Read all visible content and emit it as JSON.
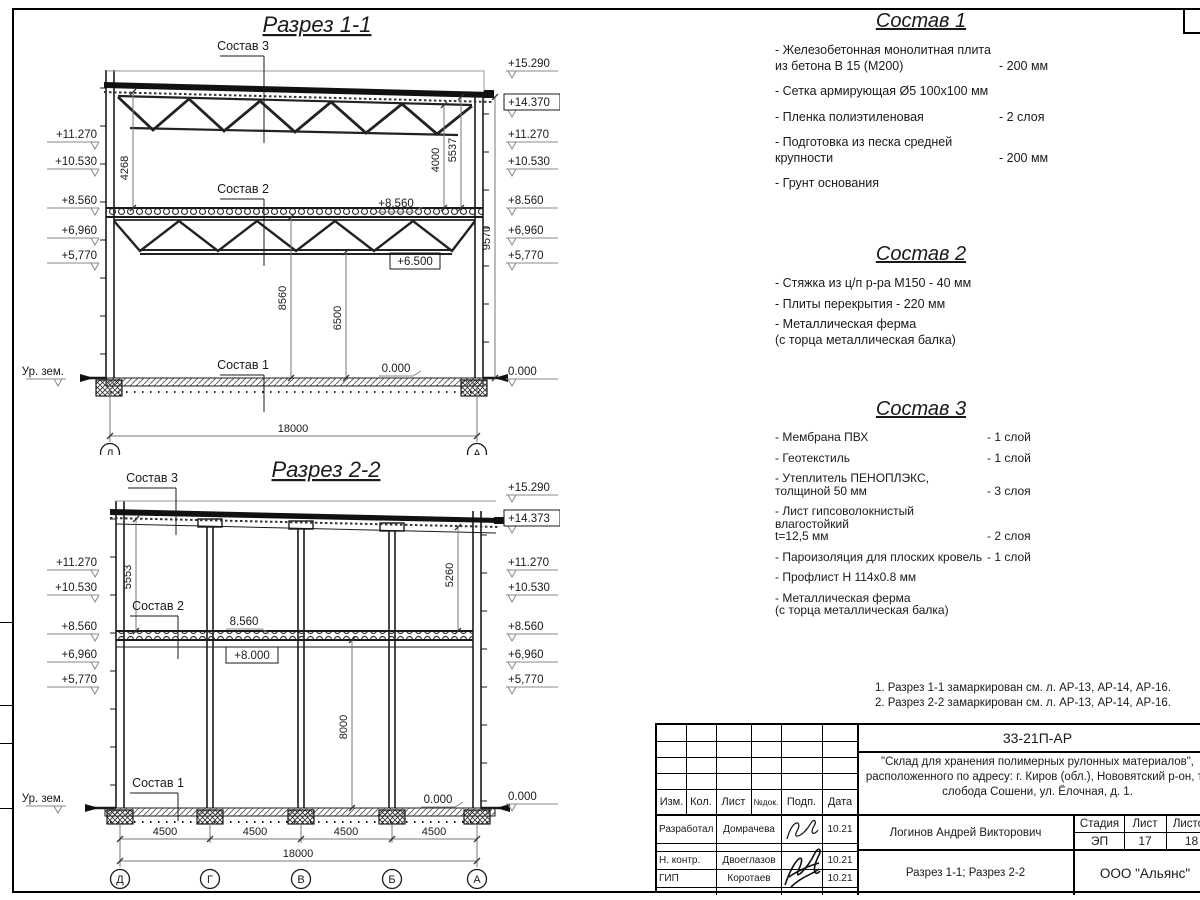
{
  "s1": {
    "title": "Разрез 1-1",
    "elev_left": [
      "+11.270",
      "+10.530",
      "+8.560",
      "+6,960",
      "+5,770"
    ],
    "elev_right": [
      "+15.290",
      "+14.370",
      "+11.270",
      "+10.530",
      "+8.560",
      "+6,960",
      "+5,770",
      "0.000"
    ],
    "ground": "Ур. зем.",
    "labels": {
      "sostav3": "Состав 3",
      "sostav2": "Состав 2",
      "sostav1": "Состав 1",
      "lvl8560": "+8.560",
      "lvl6500": "+6.500",
      "lvl0": "0.000"
    },
    "dims": {
      "d4268": "4268",
      "d4000": "4000",
      "d5537": "5537",
      "d9570": "9570",
      "d8560": "8560",
      "d6500": "6500",
      "span": "18000"
    },
    "axes": [
      "Д",
      "А"
    ]
  },
  "s2": {
    "title": "Разрез 2-2",
    "elev_left": [
      "+11.270",
      "+10.530",
      "+8.560",
      "+6,960",
      "+5,770"
    ],
    "elev_right": [
      "+15.290",
      "+14.373",
      "+11.270",
      "+10.530",
      "+8.560",
      "+6,960",
      "+5,770",
      "0.000"
    ],
    "ground": "Ур. зем.",
    "labels": {
      "sostav3": "Состав 3",
      "sostav2": "Состав 2",
      "sostav1": "Состав 1",
      "lvl8560": "8.560",
      "lvl8000": "+8.000",
      "lvl0_in": "0.000"
    },
    "dims": {
      "d5553": "5553",
      "d5260": "5260",
      "d8000": "8000",
      "spans": [
        "4500",
        "4500",
        "4500",
        "4500"
      ],
      "span": "18000"
    },
    "axes": [
      "Д",
      "Г",
      "В",
      "Б",
      "А"
    ]
  },
  "sostav1": {
    "title": "Состав 1",
    "items": [
      {
        "name": "- Железобетонная  монолитная плита\nиз бетона В 15 (М200)",
        "value": "- 200 мм"
      },
      {
        "name": "- Сетка армирующая Ø5 100х100 мм",
        "value": ""
      },
      {
        "name": "- Пленка полиэтиленовая",
        "value": "-  2 слоя"
      },
      {
        "name": "- Подготовка из песка средней\nкрупности",
        "value": "- 200 мм"
      },
      {
        "name": "- Грунт основания",
        "value": ""
      }
    ]
  },
  "sostav2": {
    "title": "Состав 2",
    "items": [
      {
        "name": "- Стяжка из ц/п р-ра М150 - 40 мм",
        "value": ""
      },
      {
        "name": "- Плиты перекрытия - 220 мм",
        "value": ""
      },
      {
        "name": "- Металлическая ферма\n(с торца металлическая балка)",
        "value": ""
      }
    ]
  },
  "sostav3": {
    "title": "Состав 3",
    "items": [
      {
        "name": "- Мембрана ПВХ",
        "value": "- 1 слой"
      },
      {
        "name": "- Геотекстиль",
        "value": "- 1 слой"
      },
      {
        "name": "- Утеплитель ПЕНОПЛЭКС,\nтолщиной 50 мм",
        "value": "- 3 слоя"
      },
      {
        "name": "- Лист гипсоволокнистый влагостойкий\nt=12,5 мм",
        "value": "- 2 слоя"
      },
      {
        "name": "- Пароизоляция для плоских кровель",
        "value": "- 1 слой"
      },
      {
        "name": "- Профлист Н 114х0.8 мм",
        "value": ""
      },
      {
        "name": "- Металлическая ферма\n(с торца металлическая балка)",
        "value": ""
      }
    ]
  },
  "notes": [
    "1. Разрез 1-1 замаркирован см. л. АР-13, АР-14, АР-16.",
    "2. Разрез 2-2 замаркирован см. л. АР-13, АР-14, АР-16."
  ],
  "tb": {
    "code": "33-21П-АР",
    "project_lines": [
      "\"Склад для хранения полимерных рулонных материалов\",",
      "расположенного по адресу: г. Киров (обл.), Нововятский р-он, те",
      "слобода Сошени, ул. Ёлочная, д. 1."
    ],
    "cols": [
      "Изм.",
      "Кол.",
      "Лист",
      "№док.",
      "Подп.",
      "Дата"
    ],
    "rows": [
      {
        "role": "Разработал",
        "name": "Домрачева",
        "date": "10.21"
      },
      {
        "role": "Н. контр.",
        "name": "Двоеглазов",
        "date": "10.21"
      },
      {
        "role": "ГИП",
        "name": "Коротаев",
        "date": "10.21"
      }
    ],
    "author": "Логинов Андрей Викторович",
    "stage_label": "Стадия",
    "sheet_label": "Лист",
    "sheets_label": "Листов",
    "stage": "ЭП",
    "sheet_num": "17",
    "sheets_total": "18",
    "content": "Разрез 1-1; Разрез 2-2",
    "company": "ООО \"Альянс\""
  }
}
